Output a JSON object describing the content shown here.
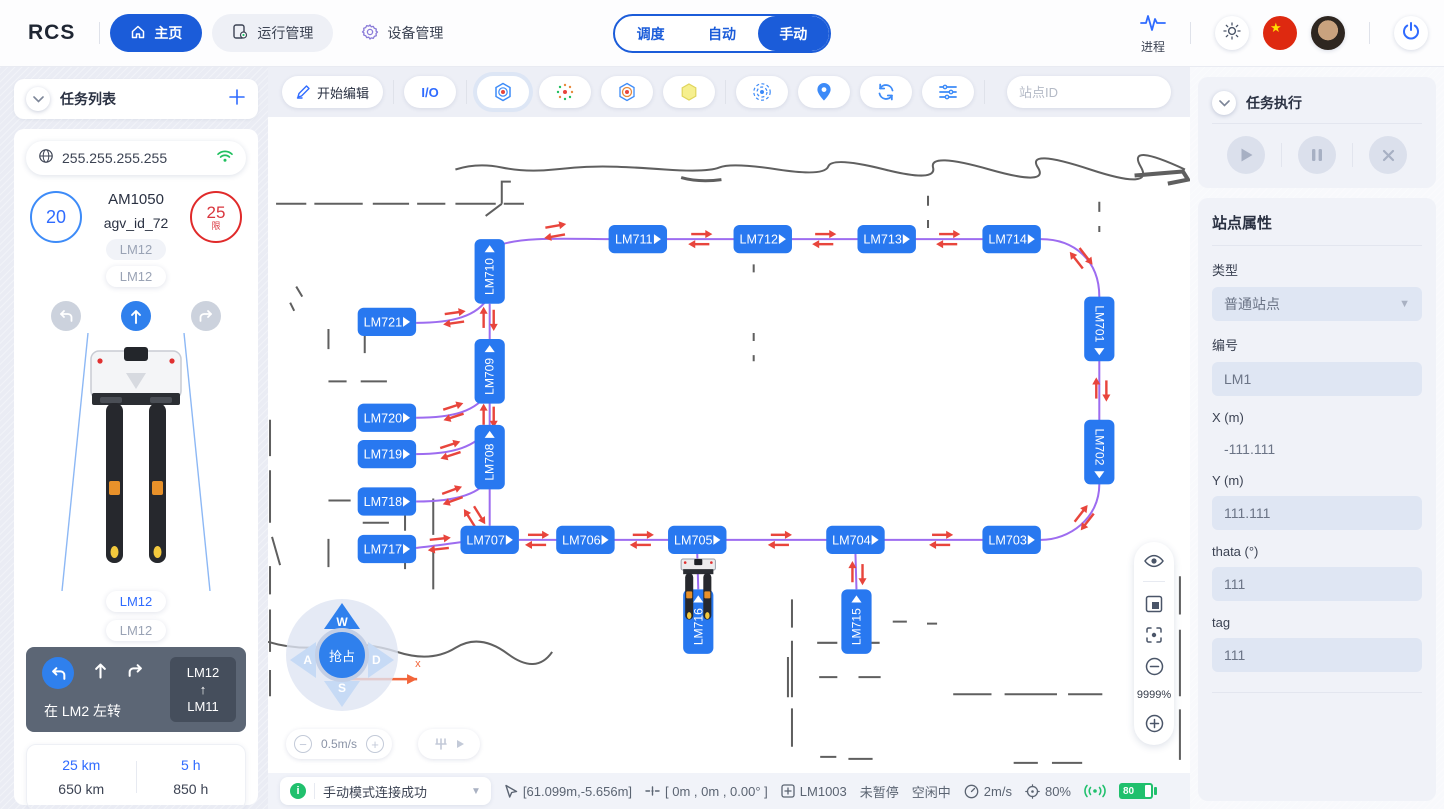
{
  "theme": {
    "primary": "#1b5cd9",
    "node_blue": "#2878f0",
    "path_purple": "#9d6cf0",
    "arrow_red": "#e8453c",
    "success_green": "#20c06d",
    "danger_red": "#d9363e"
  },
  "nav": {
    "brand": "RCS",
    "items": [
      {
        "label": "主页"
      },
      {
        "label": "运行管理"
      },
      {
        "label": "设备管理"
      }
    ],
    "modes": [
      "调度",
      "自动",
      "手动"
    ],
    "active_mode": "手动",
    "process_label": "进程"
  },
  "left": {
    "task_list_title": "任务列表",
    "ip": "255.255.255.255",
    "speed_value": "20",
    "limit_value": "25",
    "limit_suffix": "限",
    "model": "AM1050",
    "agv_id": "agv_id_72",
    "station_chip_1": "LM12",
    "station_chip_2": "LM12",
    "station_chip_3": "LM12",
    "station_chip_4": "LM12",
    "nav_card": {
      "text": "在 LM2 左转",
      "from": "LM12",
      "arrow": "↑",
      "to": "LM11"
    },
    "stats": {
      "trip_km": "25 km",
      "total_km": "650 km",
      "trip_h": "5 h",
      "total_h": "850 h"
    }
  },
  "map_toolbar": {
    "edit_label": "开始编辑",
    "io_label": "I/O",
    "search_placeholder": "站点ID"
  },
  "map": {
    "zoom_percent": "9999%",
    "axis_label": "x",
    "speed_value": "0.5m/s",
    "joystick": {
      "center": "抢占",
      "up": "W",
      "left": "A",
      "down": "S",
      "right": "D"
    },
    "nodes": [
      {
        "label": "LM710",
        "x": 220,
        "y": 153,
        "o": "vu"
      },
      {
        "label": "LM711",
        "x": 367,
        "y": 121,
        "o": "h"
      },
      {
        "label": "LM712",
        "x": 491,
        "y": 121,
        "o": "h"
      },
      {
        "label": "LM713",
        "x": 614,
        "y": 121,
        "o": "h"
      },
      {
        "label": "LM714",
        "x": 738,
        "y": 121,
        "o": "h"
      },
      {
        "label": "LM721",
        "x": 118,
        "y": 203,
        "o": "h"
      },
      {
        "label": "LM709",
        "x": 220,
        "y": 252,
        "o": "vu"
      },
      {
        "label": "LM720",
        "x": 118,
        "y": 298,
        "o": "h"
      },
      {
        "label": "LM719",
        "x": 118,
        "y": 334,
        "o": "h"
      },
      {
        "label": "LM708",
        "x": 220,
        "y": 337,
        "o": "vu"
      },
      {
        "label": "LM718",
        "x": 118,
        "y": 381,
        "o": "h"
      },
      {
        "label": "LM717",
        "x": 118,
        "y": 428,
        "o": "h"
      },
      {
        "label": "LM707",
        "x": 220,
        "y": 419,
        "o": "h"
      },
      {
        "label": "LM706",
        "x": 315,
        "y": 419,
        "o": "h"
      },
      {
        "label": "LM705",
        "x": 426,
        "y": 419,
        "o": "h"
      },
      {
        "label": "LM704",
        "x": 583,
        "y": 419,
        "o": "h"
      },
      {
        "label": "LM703",
        "x": 738,
        "y": 419,
        "o": "h"
      },
      {
        "label": "LM701",
        "x": 825,
        "y": 210,
        "o": "vd"
      },
      {
        "label": "LM702",
        "x": 825,
        "y": 332,
        "o": "vd"
      },
      {
        "label": "LM716",
        "x": 427,
        "y": 500,
        "o": "vu"
      },
      {
        "label": "LM715",
        "x": 584,
        "y": 500,
        "o": "vu"
      }
    ],
    "arrows": [
      {
        "x": 285,
        "y": 113,
        "a": -10
      },
      {
        "x": 429,
        "y": 121,
        "a": 0
      },
      {
        "x": 552,
        "y": 121,
        "a": 0
      },
      {
        "x": 675,
        "y": 121,
        "a": 0
      },
      {
        "x": 807,
        "y": 140,
        "a": 52
      },
      {
        "x": 827,
        "y": 270,
        "a": -90
      },
      {
        "x": 810,
        "y": 397,
        "a": 128
      },
      {
        "x": 668,
        "y": 419,
        "a": 0
      },
      {
        "x": 508,
        "y": 419,
        "a": 0
      },
      {
        "x": 371,
        "y": 419,
        "a": 0
      },
      {
        "x": 267,
        "y": 419,
        "a": 0
      },
      {
        "x": 585,
        "y": 452,
        "a": -90
      },
      {
        "x": 219,
        "y": 200,
        "a": -90
      },
      {
        "x": 219,
        "y": 296,
        "a": -90
      },
      {
        "x": 185,
        "y": 199,
        "a": -8
      },
      {
        "x": 184,
        "y": 292,
        "a": -18
      },
      {
        "x": 181,
        "y": 330,
        "a": -18
      },
      {
        "x": 183,
        "y": 375,
        "a": -20
      },
      {
        "x": 205,
        "y": 396,
        "a": 58
      },
      {
        "x": 170,
        "y": 423,
        "a": -6
      }
    ]
  },
  "right": {
    "exec_title": "任务执行",
    "props_title": "站点属性",
    "fields": [
      {
        "label": "类型",
        "value": "普通站点"
      },
      {
        "label": "编号",
        "value": "LM1"
      },
      {
        "label": "X (m)",
        "value": "-111.111"
      },
      {
        "label": "Y (m)",
        "value": "111.111"
      },
      {
        "label": "thata (°)",
        "value": "111"
      },
      {
        "label": "tag",
        "value": "111"
      }
    ]
  },
  "statusbar": {
    "message": "手动模式连接成功",
    "coords": "[61.099m,-5.656m]",
    "pose": "[ 0m , 0m , 0.00° ]",
    "station": "LM1003",
    "pause_state": "未暂停",
    "idle_state": "空闲中",
    "speed": "2m/s",
    "percent": "80%",
    "battery": "80"
  }
}
